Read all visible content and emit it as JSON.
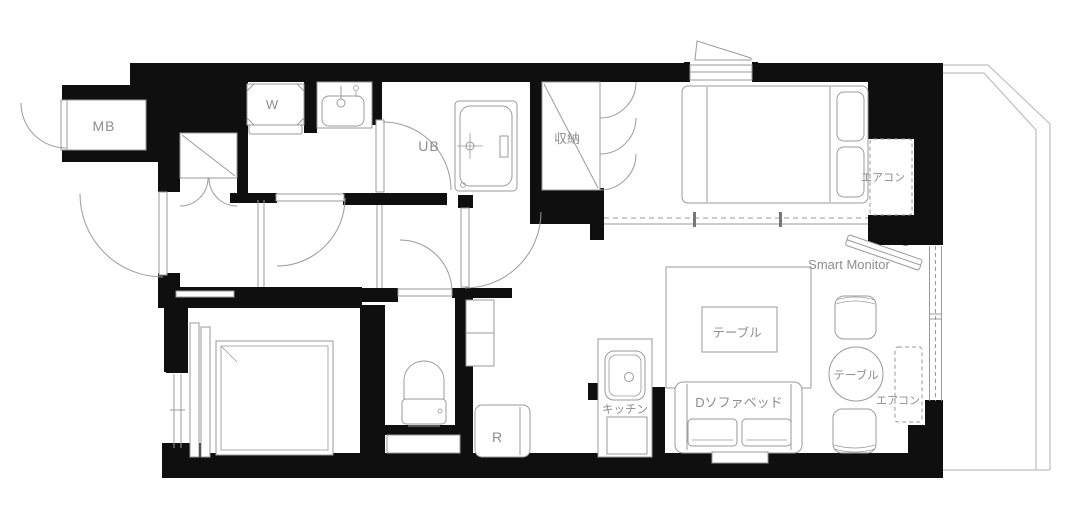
{
  "floorplan": {
    "labels": {
      "meter_box": "MB",
      "washing_machine": "W",
      "unit_bath": "UB",
      "storage": "収納",
      "bedroom_aircon": "エアコン",
      "living_aircon": "エアコン",
      "smart_monitor": "Smart Monitor",
      "living_table": "テーブル",
      "round_table": "テーブル",
      "kitchen": "キッチン",
      "sofa_bed": "Dソファベッド",
      "refrigerator": "R"
    },
    "colors": {
      "wall": "#0f0f0f",
      "line": "#9a9a9a",
      "label": "#8d8d8d",
      "balcony": "#bfbfbf",
      "bg": "#ffffff"
    }
  }
}
